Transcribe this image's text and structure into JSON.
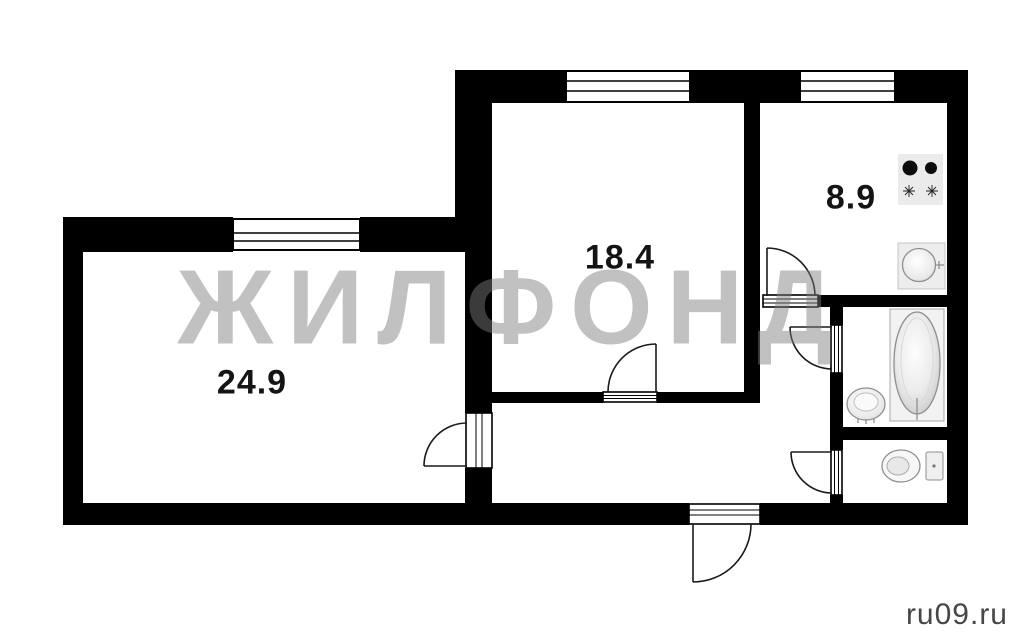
{
  "watermark_text": "ЖИЛФОНД",
  "site_credit": "ru09.ru",
  "rooms": [
    {
      "name": "living-room",
      "area_label": "24.9"
    },
    {
      "name": "bedroom",
      "area_label": "18.4"
    },
    {
      "name": "kitchen",
      "area_label": "8.9"
    }
  ],
  "fixtures": [
    "stove",
    "kitchen-sink",
    "bathtub",
    "bathroom-sink",
    "toilet"
  ],
  "colors": {
    "wall": "#000000",
    "background": "#ffffff",
    "watermark_gray": "#7d7d7d",
    "door_line": "#1a1a1a",
    "fixture_line": "#8f8f8f"
  }
}
